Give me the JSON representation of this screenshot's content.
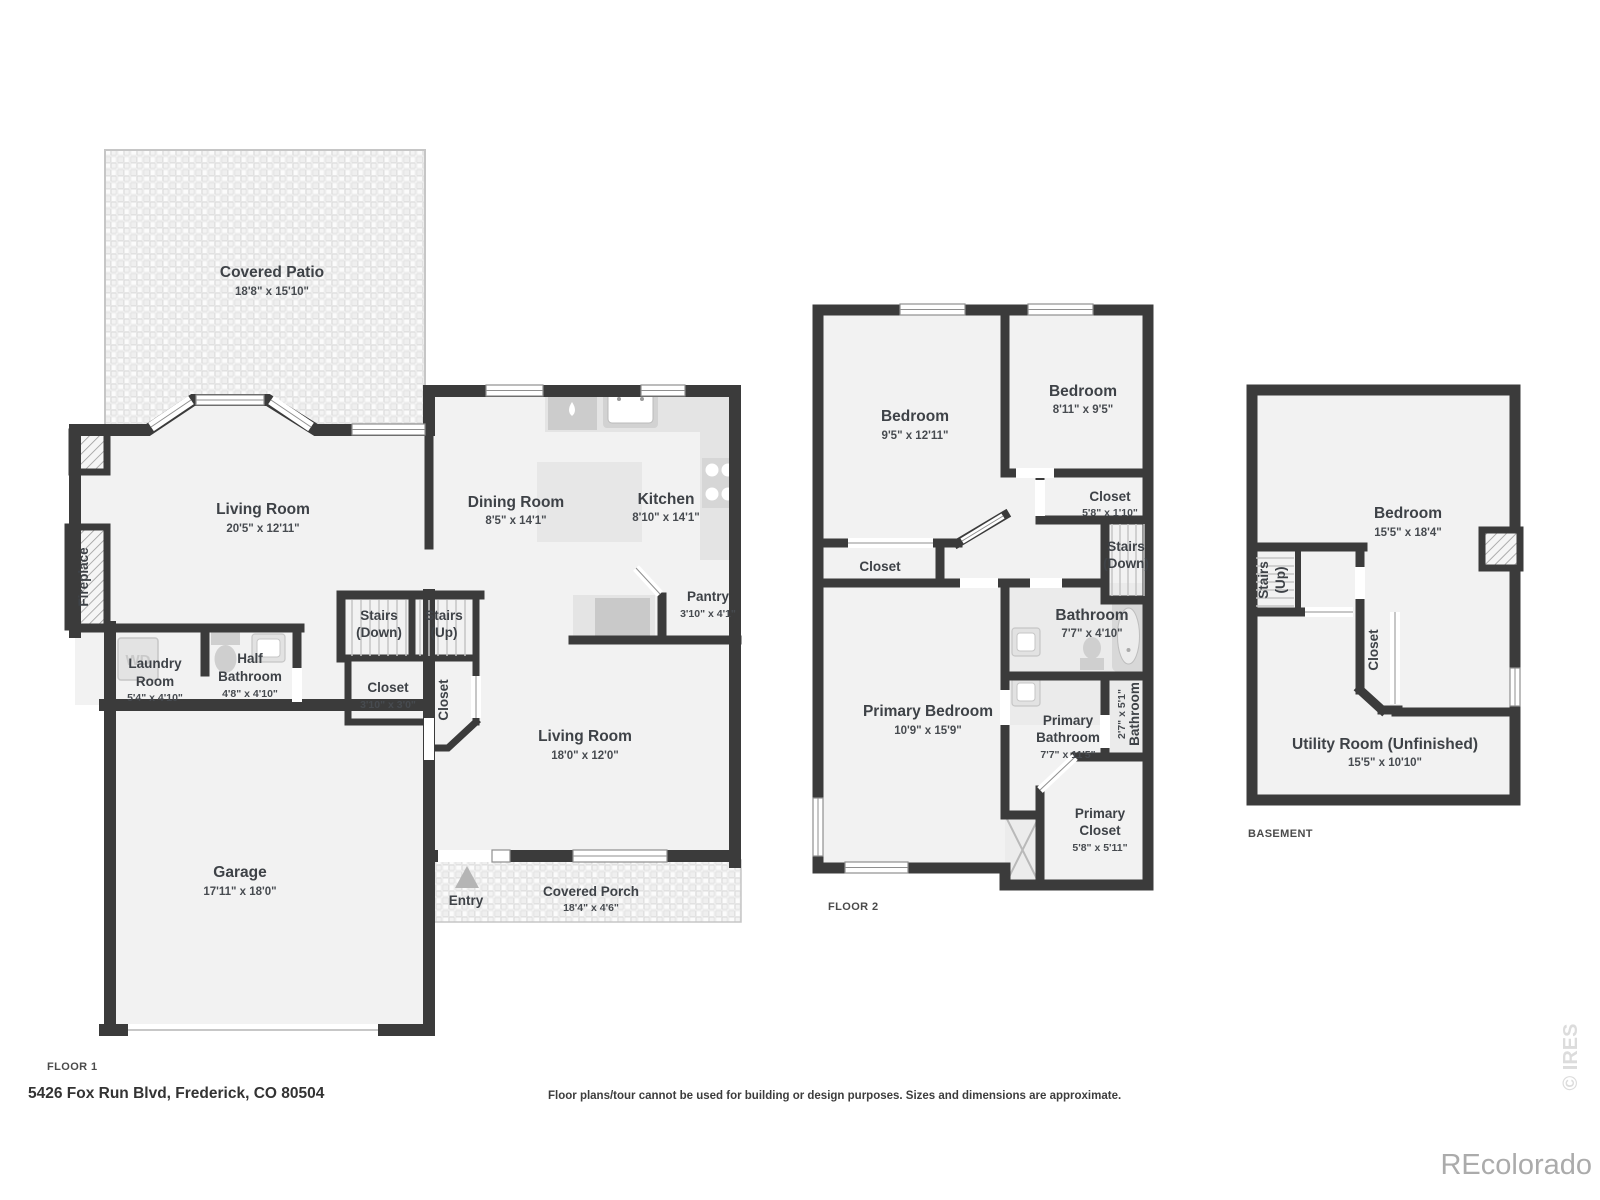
{
  "meta": {
    "address": "5426 Fox Run Blvd, Frederick, CO 80504",
    "disclaimer": "Floor plans/tour cannot be used for building or design purposes. Sizes and dimensions are approximate.",
    "watermark": "REcolorado",
    "copyright": "© IRES"
  },
  "colors": {
    "wall": "#3b3b3b",
    "room_fill": "#f2f2f2",
    "bath_fill": "#ebebeb",
    "text": "#3e4247",
    "fixture": "#d9d9d9",
    "watermark": "#ababab"
  },
  "floor1": {
    "label": "FLOOR 1",
    "covered_patio": {
      "name": "Covered Patio",
      "dims": "18'8\" x 15'10\""
    },
    "living_room": {
      "name": "Living Room",
      "dims": "20'5\" x 12'11\""
    },
    "dining_room": {
      "name": "Dining Room",
      "dims": "8'5\" x 14'1\""
    },
    "kitchen": {
      "name": "Kitchen",
      "dims": "8'10\" x 14'1\""
    },
    "pantry": {
      "name": "Pantry",
      "dims": "3'10\" x 4'1\""
    },
    "stairs_down": {
      "line1": "Stairs",
      "line2": "(Down)"
    },
    "stairs_up": {
      "line1": "Stairs",
      "line2": "(Up)"
    },
    "closet": {
      "name": "Closet",
      "dims": "3'10\" x 3'0\""
    },
    "closet_side": {
      "name": "Closet"
    },
    "laundry_room": {
      "line1": "Laundry",
      "line2": "Room",
      "dims": "5'4\" x 4'10\""
    },
    "half_bathroom": {
      "line1": "Half",
      "line2": "Bathroom",
      "dims": "4'8\" x 4'10\""
    },
    "fireplace": {
      "name": "Fireplace"
    },
    "washer_dryer": {
      "label": "WD"
    },
    "living_room2": {
      "name": "Living Room",
      "dims": "18'0\" x 12'0\""
    },
    "garage": {
      "name": "Garage",
      "dims": "17'11\" x 18'0\""
    },
    "entry": {
      "name": "Entry"
    },
    "covered_porch": {
      "name": "Covered Porch",
      "dims": "18'4\" x 4'6\""
    }
  },
  "floor2": {
    "label": "FLOOR 2",
    "bedroom_left": {
      "name": "Bedroom",
      "dims": "9'5\" x 12'11\""
    },
    "bedroom_right": {
      "name": "Bedroom",
      "dims": "8'11\" x 9'5\""
    },
    "closet_right": {
      "name": "Closet",
      "dims": "5'8\" x 1'10\""
    },
    "stairs_down": {
      "line1": "Stairs",
      "line2": "(Down)"
    },
    "closet_left": {
      "name": "Closet"
    },
    "bathroom": {
      "name": "Bathroom",
      "dims": "7'7\" x 4'10\""
    },
    "primary_bedroom": {
      "name": "Primary Bedroom",
      "dims": "10'9\" x 15'9\""
    },
    "primary_bathroom": {
      "line1": "Primary",
      "line2": "Bathroom",
      "dims": "7'7\" x 11'5\""
    },
    "bathroom_small": {
      "name": "Bathroom",
      "dims": "2'7\" x 5'1\""
    },
    "primary_closet": {
      "line1": "Primary",
      "line2": "Closet",
      "dims": "5'8\" x 5'11\""
    }
  },
  "basement": {
    "label": "BASEMENT",
    "bedroom": {
      "name": "Bedroom",
      "dims": "15'5\" x 18'4\""
    },
    "stairs_up": {
      "line1": "Stairs",
      "line2": "(Up)"
    },
    "closet": {
      "name": "Closet"
    },
    "utility_room": {
      "name": "Utility Room (Unfinished)",
      "dims": "15'5\" x 10'10\""
    }
  }
}
